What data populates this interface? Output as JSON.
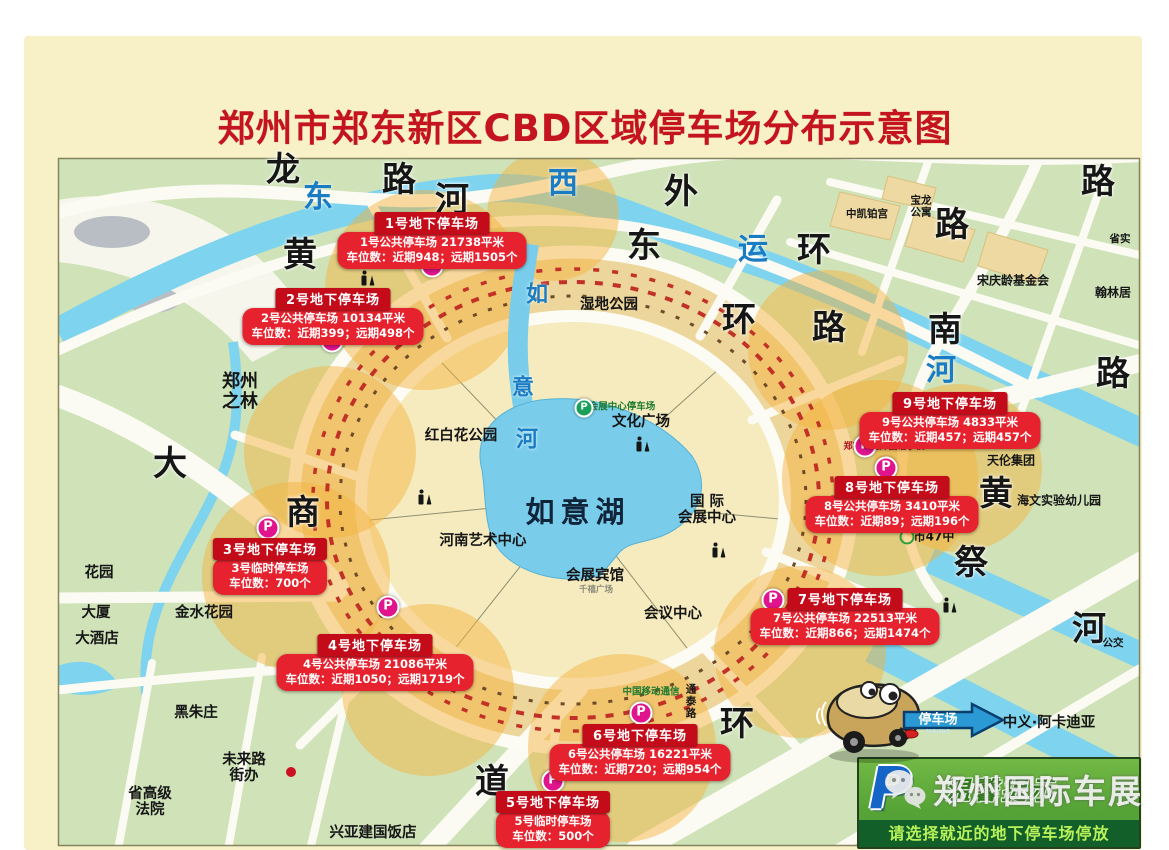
{
  "title": "郑州市郑东新区CBD区域停车场分布示意图",
  "colors": {
    "title_red": "#c41420",
    "callout_red": "#e6222e",
    "callout_header_red": "#c30b1a",
    "map_green": "#cfe2b8",
    "water_blue": "#7ed3ee",
    "halo_orange": "#f4b23c",
    "marker_magenta": "#e0148c",
    "tip_green_dark": "#135f29",
    "tip_text_green": "#b7f25a",
    "p_blue": "#1565c8"
  },
  "callouts": [
    {
      "x": 432,
      "y": 212,
      "title": "1号地下停车场",
      "line1": "1号公共停车场 21738平米",
      "line2": "车位数：近期948；远期1505个"
    },
    {
      "x": 333,
      "y": 288,
      "title": "2号地下停车场",
      "line1": "2号公共停车场 10134平米",
      "line2": "车位数：近期399；远期498个"
    },
    {
      "x": 270,
      "y": 538,
      "title": "3号地下停车场",
      "line1": "3号临时停车场",
      "line2": "车位数：700个"
    },
    {
      "x": 375,
      "y": 634,
      "title": "4号地下停车场",
      "line1": "4号公共停车场 21086平米",
      "line2": "车位数：近期1050；远期1719个"
    },
    {
      "x": 553,
      "y": 791,
      "title": "5号地下停车场",
      "line1": "5号临时停车场",
      "line2": "车位数：500个"
    },
    {
      "x": 640,
      "y": 724,
      "title": "6号地下停车场",
      "line1": "6号公共停车场 16221平米",
      "line2": "车位数：近期720；远期954个"
    },
    {
      "x": 845,
      "y": 588,
      "title": "7号地下停车场",
      "line1": "7号公共停车场 22513平米",
      "line2": "车位数：近期866；远期1474个"
    },
    {
      "x": 892,
      "y": 476,
      "title": "8号地下停车场",
      "line1": "8号公共停车场 3410平米",
      "line2": "车位数：近期89；远期196个"
    },
    {
      "x": 950,
      "y": 392,
      "title": "9号地下停车场",
      "line1": "9号公共停车场 4833平米",
      "line2": "车位数：近期457；远期457个"
    }
  ],
  "map_labels": [
    {
      "text": "龙",
      "x": 283,
      "y": 170,
      "cls": "road-xl"
    },
    {
      "text": "路",
      "x": 399,
      "y": 180,
      "cls": "road-xl"
    },
    {
      "text": "河",
      "x": 452,
      "y": 200,
      "cls": "road-xl"
    },
    {
      "text": "东",
      "x": 318,
      "y": 198,
      "cls": "river"
    },
    {
      "text": "黄",
      "x": 300,
      "y": 255,
      "cls": "road-xl"
    },
    {
      "text": "西",
      "x": 563,
      "y": 184,
      "cls": "river"
    },
    {
      "text": "外",
      "x": 681,
      "y": 192,
      "cls": "road-xl"
    },
    {
      "text": "东",
      "x": 644,
      "y": 246,
      "cls": "road-xl"
    },
    {
      "text": "运",
      "x": 753,
      "y": 250,
      "cls": "river"
    },
    {
      "text": "环",
      "x": 814,
      "y": 250,
      "cls": "road-xl"
    },
    {
      "text": "路",
      "x": 952,
      "y": 225,
      "cls": "road-xl"
    },
    {
      "text": "路",
      "x": 1098,
      "y": 182,
      "cls": "road-xl"
    },
    {
      "text": "环",
      "x": 739,
      "y": 320,
      "cls": "road-xl"
    },
    {
      "text": "路",
      "x": 829,
      "y": 328,
      "cls": "road-xl"
    },
    {
      "text": "南",
      "x": 945,
      "y": 330,
      "cls": "road-xl"
    },
    {
      "text": "河",
      "x": 941,
      "y": 371,
      "cls": "river"
    },
    {
      "text": "路",
      "x": 1113,
      "y": 374,
      "cls": "road-xl"
    },
    {
      "text": "祭",
      "x": 971,
      "y": 563,
      "cls": "road-xl"
    },
    {
      "text": "黄",
      "x": 996,
      "y": 494,
      "cls": "road-xl"
    },
    {
      "text": "河",
      "x": 1089,
      "y": 629,
      "cls": "road-xl"
    },
    {
      "text": "大",
      "x": 170,
      "y": 464,
      "cls": "road-xl"
    },
    {
      "text": "商",
      "x": 303,
      "y": 513,
      "cls": "road-xl"
    },
    {
      "text": "道",
      "x": 492,
      "y": 782,
      "cls": "road-xl"
    },
    {
      "text": "环",
      "x": 737,
      "y": 724,
      "cls": "road-xl"
    },
    {
      "text": "如",
      "x": 537,
      "y": 296,
      "cls": "river-sm"
    },
    {
      "text": "意",
      "x": 523,
      "y": 389,
      "cls": "river-sm"
    },
    {
      "text": "河",
      "x": 527,
      "y": 441,
      "cls": "river-sm"
    },
    {
      "text": "如意湖",
      "x": 578,
      "y": 512,
      "cls": "lake-name"
    },
    {
      "text": "郑州\n之林",
      "x": 240,
      "y": 392,
      "cls": "area-lg"
    },
    {
      "text": "湿地公园",
      "x": 609,
      "y": 305,
      "cls": "area"
    },
    {
      "text": "红白花公园",
      "x": 461,
      "y": 436,
      "cls": "area"
    },
    {
      "text": "文化广场",
      "x": 641,
      "y": 422,
      "cls": "area"
    },
    {
      "text": "国 际\n会展中心",
      "x": 707,
      "y": 510,
      "cls": "area"
    },
    {
      "text": "河南艺术中心",
      "x": 483,
      "y": 541,
      "cls": "area"
    },
    {
      "text": "会展宾馆",
      "x": 595,
      "y": 576,
      "cls": "area"
    },
    {
      "text": "千禧广场",
      "x": 596,
      "y": 591,
      "cls": "gray-xs"
    },
    {
      "text": "会议中心",
      "x": 673,
      "y": 614,
      "cls": "area"
    },
    {
      "text": "金水花园",
      "x": 204,
      "y": 613,
      "cls": "area"
    },
    {
      "text": "花园",
      "x": 99,
      "y": 573,
      "cls": "area"
    },
    {
      "text": "大厦",
      "x": 96,
      "y": 613,
      "cls": "area"
    },
    {
      "text": "大酒店",
      "x": 97,
      "y": 639,
      "cls": "area"
    },
    {
      "text": "黑朱庄",
      "x": 196,
      "y": 713,
      "cls": "area"
    },
    {
      "text": "未来路\n街办",
      "x": 244,
      "y": 768,
      "cls": "area"
    },
    {
      "text": "省高级\n法院",
      "x": 150,
      "y": 802,
      "cls": "area"
    },
    {
      "text": "兴亚建国饭店",
      "x": 373,
      "y": 833,
      "cls": "area"
    },
    {
      "text": "天伦集团",
      "x": 1011,
      "y": 461,
      "cls": "area-sm"
    },
    {
      "text": "海文实验幼儿园",
      "x": 1059,
      "y": 501,
      "cls": "area-sm"
    },
    {
      "text": "市47中",
      "x": 934,
      "y": 537,
      "cls": "area-sm"
    },
    {
      "text": "宋庆龄基金会",
      "x": 1013,
      "y": 281,
      "cls": "area-sm"
    },
    {
      "text": "翰林居",
      "x": 1113,
      "y": 293,
      "cls": "area-sm"
    },
    {
      "text": "宝龙\n公寓",
      "x": 921,
      "y": 207,
      "cls": "area-xs"
    },
    {
      "text": "中凯铂宫",
      "x": 867,
      "y": 215,
      "cls": "area-xs"
    },
    {
      "text": "省实",
      "x": 1120,
      "y": 240,
      "cls": "area-xs"
    },
    {
      "text": "中义·阿卡迪亚",
      "x": 1049,
      "y": 723,
      "cls": "area"
    },
    {
      "text": "中国移动通信",
      "x": 651,
      "y": 693,
      "cls": "green-sm"
    },
    {
      "text": "通\n泰\n路",
      "x": 691,
      "y": 702,
      "cls": "area-xs"
    },
    {
      "text": "公交",
      "x": 1113,
      "y": 644,
      "cls": "area-xs"
    },
    {
      "text": "郑东新区外国语学校",
      "x": 884,
      "y": 447,
      "cls": "red-sm"
    },
    {
      "text": "会展中心停车场",
      "x": 622,
      "y": 408,
      "cls": "green-sm"
    }
  ],
  "p_markers": [
    {
      "x": 432,
      "y": 266,
      "label": "P"
    },
    {
      "x": 332,
      "y": 341,
      "label": "P"
    },
    {
      "x": 268,
      "y": 528,
      "label": "P"
    },
    {
      "x": 388,
      "y": 607,
      "label": "P"
    },
    {
      "x": 553,
      "y": 781,
      "label": "P"
    },
    {
      "x": 641,
      "y": 713,
      "label": "P"
    },
    {
      "x": 773,
      "y": 600,
      "label": "P"
    },
    {
      "x": 886,
      "y": 468,
      "label": "P"
    },
    {
      "x": 865,
      "y": 446,
      "label": "P"
    },
    {
      "x": 584,
      "y": 408,
      "label": "P",
      "cls": "green"
    }
  ],
  "restrooms": [
    {
      "x": 368,
      "y": 278
    },
    {
      "x": 425,
      "y": 497
    },
    {
      "x": 643,
      "y": 444
    },
    {
      "x": 719,
      "y": 550
    },
    {
      "x": 950,
      "y": 605
    }
  ],
  "poi_marks": [
    {
      "x": 291,
      "y": 772,
      "cls": "dot-red"
    },
    {
      "x": 907,
      "y": 537,
      "cls": "ring-green"
    }
  ],
  "tip_box": {
    "p": "P",
    "title": "温馨提示",
    "text": "请选择就近的地下停车场停放"
  },
  "watermark": {
    "text": "郑州国际车展"
  },
  "car_sign": {
    "text": "停车场",
    "sub": "PARKING"
  }
}
